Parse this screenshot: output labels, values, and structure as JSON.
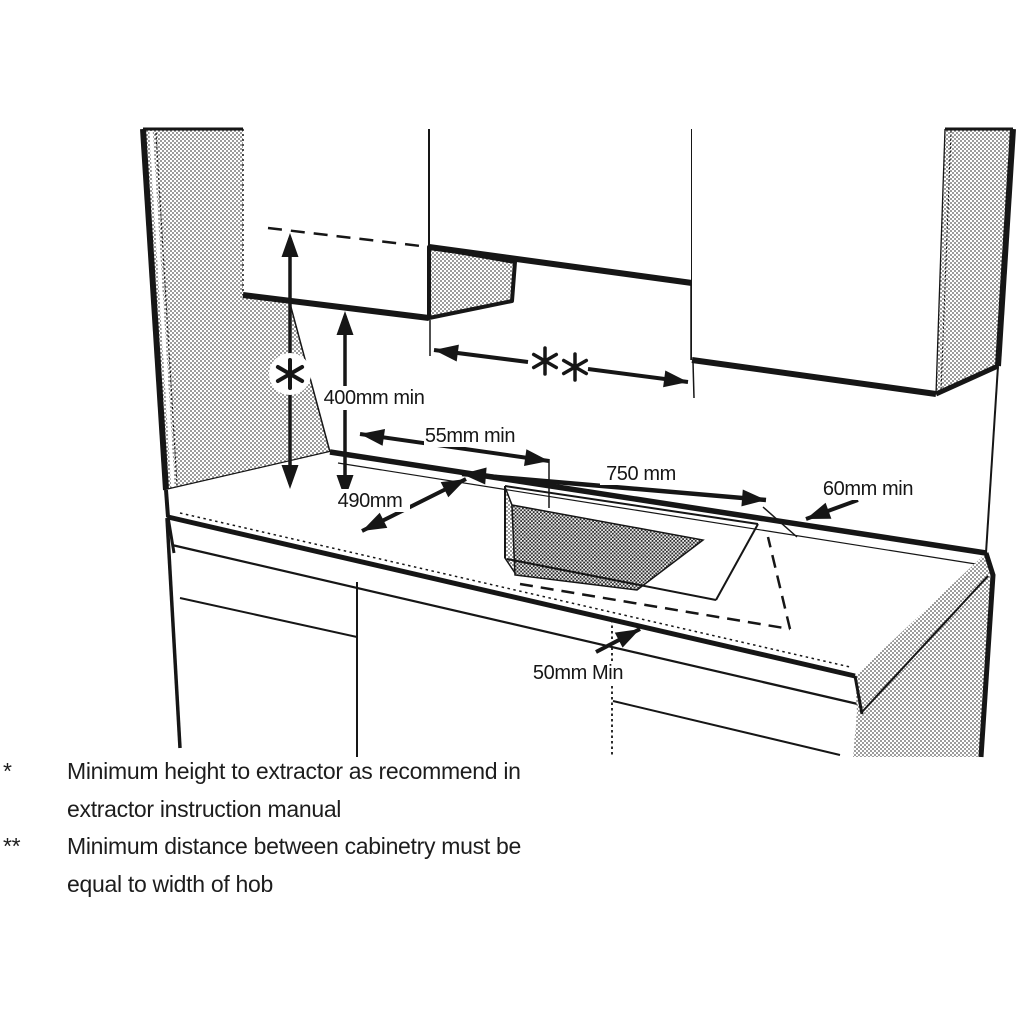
{
  "diagram": {
    "dimensions": {
      "height_to_extractor_marker": "*",
      "cabinet_gap_marker": "**",
      "wall_to_extractor": "400mm min",
      "wall_to_cutout": "55mm min",
      "cutout_width": "750 mm",
      "cutout_depth": "490mm",
      "cutout_side_clearance": "60mm min",
      "cutout_front_clearance": "50mm Min"
    },
    "colors": {
      "line": "#161616",
      "background": "#ffffff"
    }
  },
  "footnotes": [
    {
      "marker": "*",
      "line1": "Minimum height to extractor as recommend in",
      "line2": "extractor instruction manual"
    },
    {
      "marker": "**",
      "line1": "Minimum distance between cabinetry must be",
      "line2": "equal to width of hob"
    }
  ]
}
